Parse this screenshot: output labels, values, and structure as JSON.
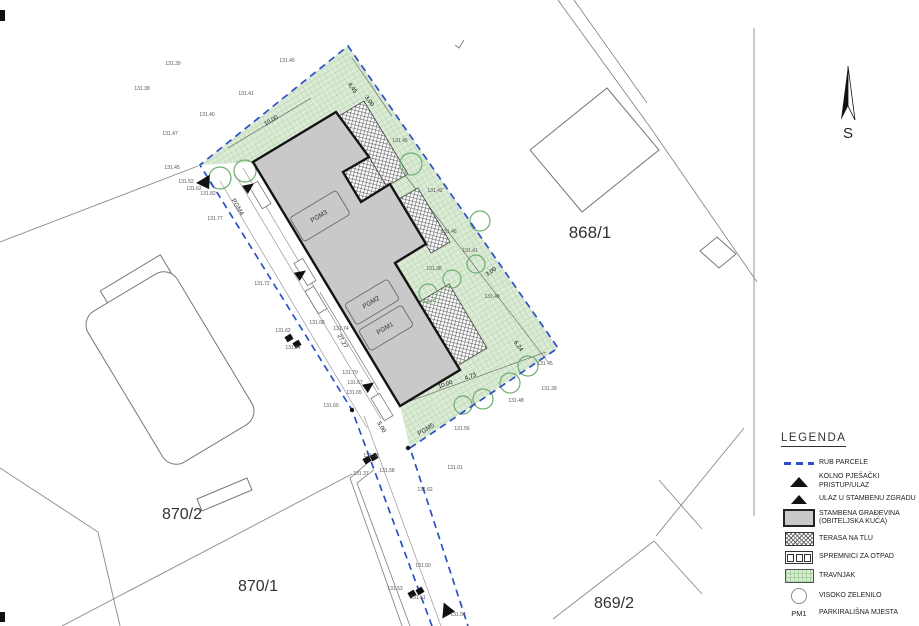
{
  "plan": {
    "north_label": "S",
    "parcels": [
      {
        "label": "868/1",
        "x": 590,
        "y": 238,
        "fs": 17
      },
      {
        "label": "870/2",
        "x": 182,
        "y": 519,
        "fs": 16
      },
      {
        "label": "870/1",
        "x": 258,
        "y": 591,
        "fs": 16
      },
      {
        "label": "869/2",
        "x": 614,
        "y": 608,
        "fs": 16
      }
    ],
    "pgm_labels": [
      {
        "t": "PGM3",
        "x": 320,
        "y": 218,
        "r": -31
      },
      {
        "t": "PGM2",
        "x": 372,
        "y": 304,
        "r": -31
      },
      {
        "t": "PGM1",
        "x": 386,
        "y": 330,
        "r": -31
      },
      {
        "t": "PGM4",
        "x": 236,
        "y": 208,
        "r": 59
      },
      {
        "t": "PGM5",
        "x": 427,
        "y": 431,
        "r": -31
      }
    ],
    "dim_labels": [
      {
        "t": "10,00",
        "x": 272,
        "y": 122,
        "r": -31
      },
      {
        "t": "4,45",
        "x": 351,
        "y": 89,
        "r": 55
      },
      {
        "t": "3,00",
        "x": 368,
        "y": 102,
        "r": 55
      },
      {
        "t": "3,00",
        "x": 492,
        "y": 273,
        "r": -35
      },
      {
        "t": "6,24",
        "x": 517,
        "y": 347,
        "r": 55
      },
      {
        "t": "10,00",
        "x": 446,
        "y": 386,
        "r": -20
      },
      {
        "t": "4,73",
        "x": 471,
        "y": 378,
        "r": -20
      },
      {
        "t": "5,00",
        "x": 380,
        "y": 428,
        "r": 59
      },
      {
        "t": "27,27",
        "x": 341,
        "y": 342,
        "r": 59
      }
    ],
    "elevations": [
      {
        "t": "131.39",
        "x": 173,
        "y": 65
      },
      {
        "t": "131.45",
        "x": 287,
        "y": 62
      },
      {
        "t": "131.38",
        "x": 142,
        "y": 90
      },
      {
        "t": "131.41",
        "x": 246,
        "y": 95
      },
      {
        "t": "131.40",
        "x": 207,
        "y": 116
      },
      {
        "t": "131.47",
        "x": 170,
        "y": 135
      },
      {
        "t": "131.45",
        "x": 172,
        "y": 169
      },
      {
        "t": "131.52",
        "x": 186,
        "y": 183
      },
      {
        "t": "131.62",
        "x": 194,
        "y": 190
      },
      {
        "t": "131.82",
        "x": 208,
        "y": 195
      },
      {
        "t": "131.77",
        "x": 215,
        "y": 220
      },
      {
        "t": "131.72",
        "x": 262,
        "y": 285
      },
      {
        "t": "131.62",
        "x": 283,
        "y": 332
      },
      {
        "t": "131.64",
        "x": 293,
        "y": 349
      },
      {
        "t": "131.68",
        "x": 317,
        "y": 324
      },
      {
        "t": "131.74",
        "x": 341,
        "y": 330
      },
      {
        "t": "131.70",
        "x": 350,
        "y": 374
      },
      {
        "t": "131.67",
        "x": 355,
        "y": 384
      },
      {
        "t": "131.65",
        "x": 354,
        "y": 394
      },
      {
        "t": "131.60",
        "x": 331,
        "y": 407
      },
      {
        "t": "131.58",
        "x": 387,
        "y": 472
      },
      {
        "t": "131.62",
        "x": 425,
        "y": 491
      },
      {
        "t": "131.56",
        "x": 462,
        "y": 430
      },
      {
        "t": "131.01",
        "x": 455,
        "y": 469
      },
      {
        "t": "131.50",
        "x": 423,
        "y": 567
      },
      {
        "t": "131.53",
        "x": 395,
        "y": 590
      },
      {
        "t": "131.51",
        "x": 418,
        "y": 599
      },
      {
        "t": "131.54",
        "x": 458,
        "y": 616
      },
      {
        "t": "131.53",
        "x": 371,
        "y": 457
      },
      {
        "t": "131.37",
        "x": 361,
        "y": 475
      },
      {
        "t": "131.42",
        "x": 435,
        "y": 192
      },
      {
        "t": "131.48",
        "x": 449,
        "y": 233
      },
      {
        "t": "131.41",
        "x": 470,
        "y": 252
      },
      {
        "t": "131.38",
        "x": 434,
        "y": 270
      },
      {
        "t": "131.48",
        "x": 492,
        "y": 298
      },
      {
        "t": "131.45",
        "x": 545,
        "y": 365
      },
      {
        "t": "131.39",
        "x": 549,
        "y": 390
      },
      {
        "t": "131.48",
        "x": 516,
        "y": 402
      },
      {
        "t": "131.45",
        "x": 400,
        "y": 142
      }
    ],
    "trees": [
      [
        220,
        178,
        11
      ],
      [
        245,
        171,
        11
      ],
      [
        411,
        164,
        11
      ],
      [
        480,
        221,
        10
      ],
      [
        476,
        264,
        9
      ],
      [
        452,
        279,
        9
      ],
      [
        428,
        293,
        9
      ],
      [
        528,
        366,
        10
      ],
      [
        510,
        383,
        10
      ],
      [
        483,
        399,
        10
      ],
      [
        463,
        405,
        9
      ]
    ]
  },
  "legend": {
    "title": "LEGENDA",
    "items": [
      {
        "key": "rub-parcele",
        "label": "RUB PARCELE"
      },
      {
        "key": "kolno-pjesacki-pristup",
        "label": "KOLNO PJEŠAČKI\nPRISTUP/ULAZ"
      },
      {
        "key": "ulaz-u-stambenu-zgradu",
        "label": "ULAZ U STAMBENU ZGRADU"
      },
      {
        "key": "stambena-gradevina",
        "label": "STAMBENA GRAĐEVINA\n(OBITELJSKA KUĆA)"
      },
      {
        "key": "terasa-na-tlu",
        "label": "TERASA NA TLU"
      },
      {
        "key": "spremnici-za-otpad",
        "label": "SPREMNICI ZA OTPAD"
      },
      {
        "key": "travnjak",
        "label": "TRAVNJAK"
      },
      {
        "key": "visoko-zelenilo",
        "label": "VISOKO ZELENILO"
      },
      {
        "key": "parkiralisna-mjesta",
        "label": "PARKIRALIŠNA MJESTA",
        "pm": "PM1"
      }
    ]
  },
  "colors": {
    "boundary_blue": "#2b50c8",
    "building_fill": "#c9c9c9",
    "green_fill": "#dcead6",
    "green_line": "#a8d2a4"
  }
}
